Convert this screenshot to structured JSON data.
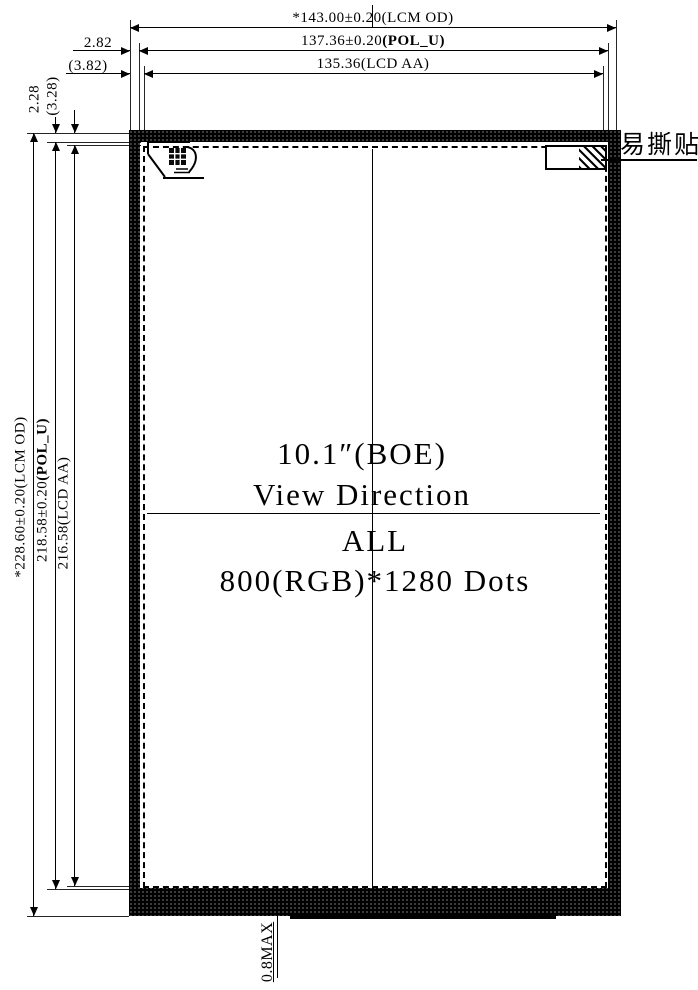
{
  "display_spec": {
    "line1": "10.1″(BOE)",
    "line2": "View Direction",
    "line3": "ALL",
    "line4": "800(RGB)*1280 Dots"
  },
  "dimensions": {
    "width_lcm": {
      "value": "*143.00±0.20",
      "ref": "(LCM OD)"
    },
    "width_pol": {
      "value": "137.36±0.20",
      "ref": "(POL_U)"
    },
    "width_aa": {
      "value": "135.36",
      "ref": "(LCD AA)"
    },
    "offset_side_pol": "2.82",
    "offset_side_aa": "(3.82)",
    "offset_top_pol": "2.28",
    "offset_top_aa": "(3.28)",
    "height_lcm": {
      "value": "*228.60±0.20",
      "ref": "(LCM OD)"
    },
    "height_pol": {
      "value": "218.58±0.20",
      "ref": "(POL_U)"
    },
    "height_aa": {
      "value": "216.58",
      "ref": "(LCD AA)"
    },
    "bottom_thickness": "0.8MAX"
  },
  "annotations": {
    "easy_tear_sticker": "易撕贴"
  },
  "colors": {
    "line": "#000000",
    "background": "#ffffff"
  }
}
